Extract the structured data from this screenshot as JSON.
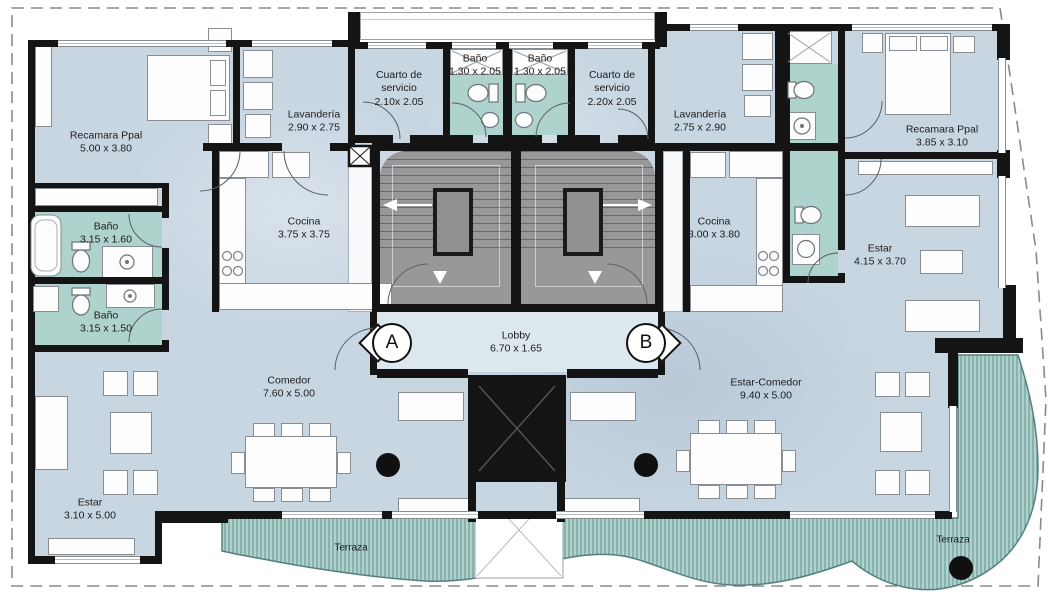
{
  "plan": {
    "colors": {
      "floor": "#c8d6e2",
      "floor_light": "#dde7ee",
      "wet_area": "#aed2cc",
      "core_gray": "#98989b",
      "deck": "#b2d2cd",
      "deck_stripe": "#5f928c",
      "wall": "#141414"
    },
    "markers": {
      "unit_a": "A",
      "unit_b": "B"
    },
    "rooms": {
      "recamara_a": {
        "name": "Recamara Ppal",
        "dims": "5.00 x 3.80"
      },
      "lavanderia_a": {
        "name": "Lavandería",
        "dims": "2.90 x 2.75"
      },
      "servicio_a": {
        "name": "Cuarto de servicio",
        "dims": "2.10x 2.05"
      },
      "bano_core_a": {
        "name": "Baño",
        "dims": "1.30 x 2.05"
      },
      "bano_core_b": {
        "name": "Baño",
        "dims": "1.30 x 2.05"
      },
      "servicio_b": {
        "name": "Cuarto de servicio",
        "dims": "2.20x 2.05"
      },
      "lavanderia_b": {
        "name": "Lavandería",
        "dims": "2.75 x 2.90"
      },
      "recamara_b": {
        "name": "Recamara Ppal",
        "dims": "3.85 x 3.10"
      },
      "bano_a1": {
        "name": "Baño",
        "dims": "3.15 x 1.60"
      },
      "bano_a2": {
        "name": "Baño",
        "dims": "3.15 x 1.50"
      },
      "cocina_a": {
        "name": "Cocina",
        "dims": "3.75 x 3.75"
      },
      "cocina_b": {
        "name": "Cocina",
        "dims": "3.00 x 3.80"
      },
      "estar_b": {
        "name": "Estar",
        "dims": "4.15 x 3.70"
      },
      "lobby": {
        "name": "Lobby",
        "dims": "6.70 x 1.65"
      },
      "comedor_a": {
        "name": "Comedor",
        "dims": "7.60 x 5.00"
      },
      "estar_comedor_b": {
        "name": "Estar-Comedor",
        "dims": "9.40 x 5.00"
      },
      "estar_a": {
        "name": "Estar",
        "dims": "3.10 x 5.00"
      },
      "terraza_a": {
        "name": "Terraza"
      },
      "terraza_b": {
        "name": "Terraza"
      }
    }
  }
}
